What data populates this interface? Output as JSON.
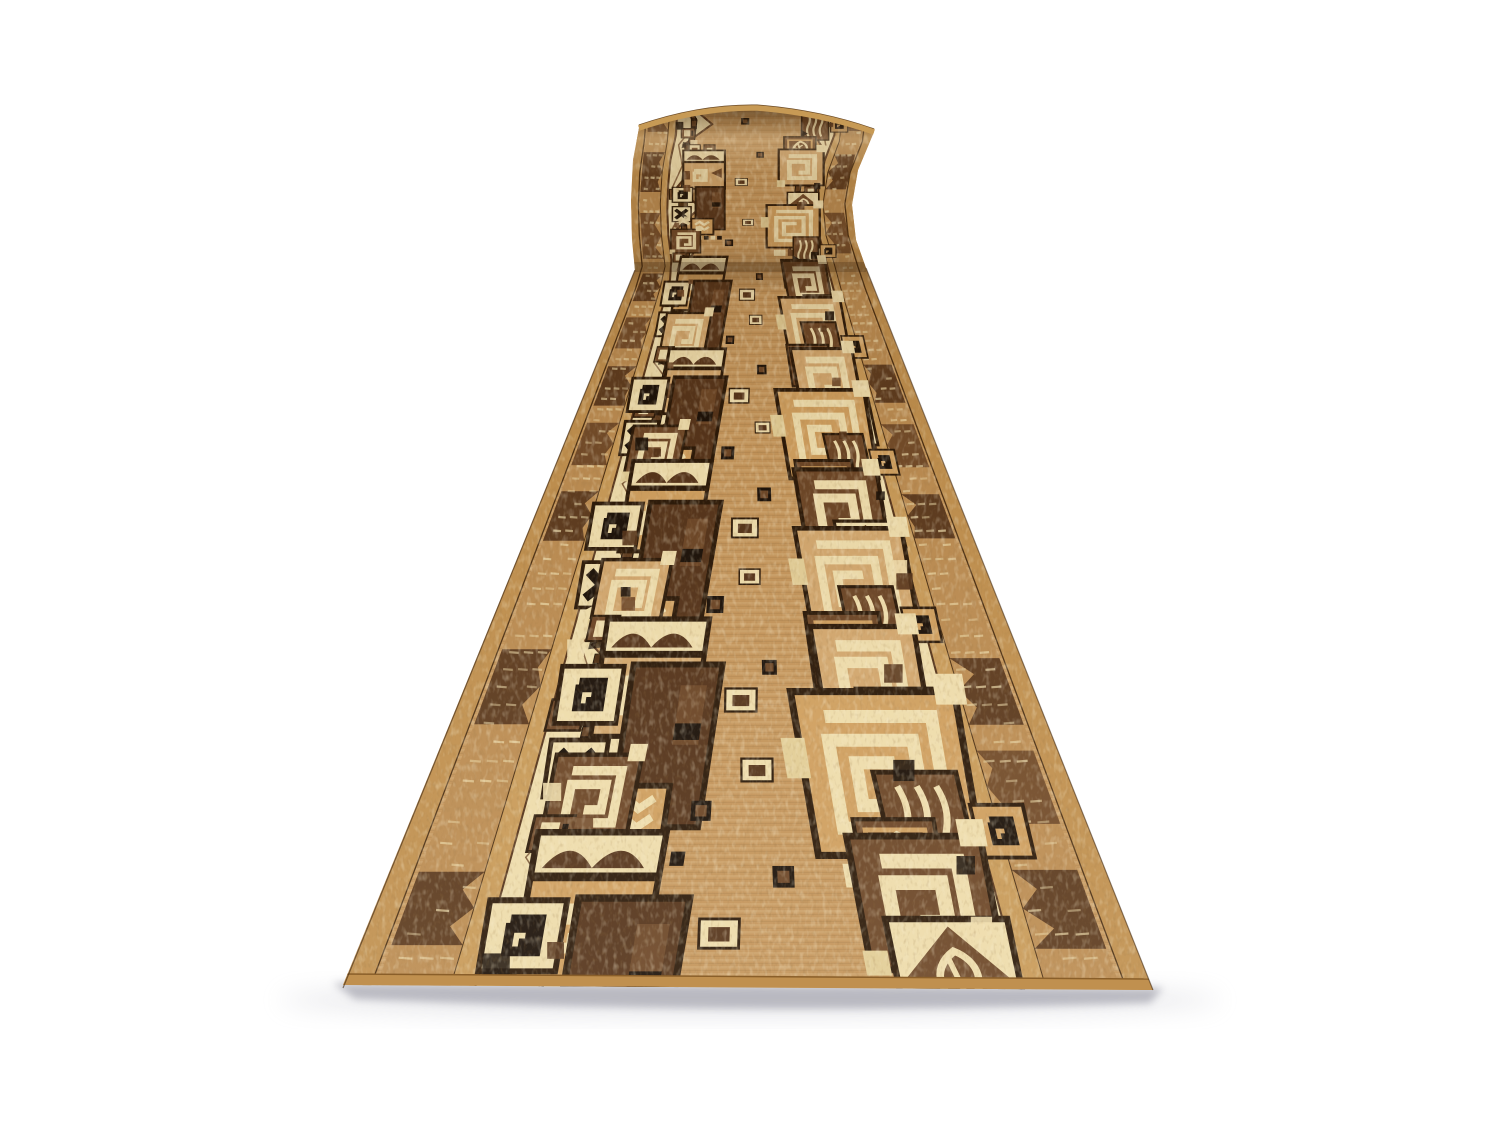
{
  "scene": {
    "kind": "product-photo",
    "subject": "beige-brown ethnic runner carpet, rolled at far end",
    "background_color": "#ffffff"
  },
  "palette": {
    "bg": "#ffffff",
    "field": "#c3945a",
    "fieldLight": "#d2a76e",
    "cream": "#eedcab",
    "creamDeep": "#e2cd96",
    "camel": "#c0904f",
    "camelLight": "#cf9f5f",
    "stripe": "#c89a58",
    "borderTan": "#bb8c52",
    "brown": "#6b4526",
    "brownDeep": "#54331a",
    "stem": "#5a381c",
    "outline": "#2a1808",
    "black": "#1a1008",
    "rim": "#c79a55",
    "shadow": "#a9a9b2",
    "shadowSoft": "#bcbcc4"
  },
  "geometry": {
    "canvas": {
      "w": 1500,
      "h": 1125
    },
    "flat": {
      "yTop": 270,
      "yBot": 988,
      "xLTop": 635,
      "xRTop": 866,
      "xLBot": 343,
      "xRBot": 1153
    },
    "repeats": 4.5,
    "rollStep": 125,
    "rollLeft": [
      [
        128,
        639
      ],
      [
        160,
        633
      ],
      [
        200,
        631
      ],
      [
        240,
        632
      ],
      [
        270,
        635
      ]
    ],
    "rollRight": [
      [
        132,
        874
      ],
      [
        170,
        858
      ],
      [
        205,
        852
      ],
      [
        240,
        856
      ],
      [
        268,
        866
      ]
    ],
    "rugOutline": "M343,985 L635,270 L632,240 L631,200 L633,160 L639,128 Q700,107 757,108 Q820,113 874,132 L858,170 L852,205 L856,240 L866,268 L1153,990 Z",
    "rollOutline": "M635,272 L632,240 L631,200 L633,160 L639,128 Q700,107 757,108 Q820,113 874,132 L858,170 L852,205 L856,240 L866,268 L866,272 Z",
    "topArc": "M639,128 Q700,107 757,108 Q820,113 874,132",
    "bottomSelvedge": [
      [
        343,
        974
      ],
      [
        1153,
        979
      ],
      [
        1153,
        990
      ],
      [
        343,
        985
      ]
    ]
  },
  "pattern": {
    "seed": 11,
    "bands": {
      "selvedge": [
        0,
        0.034
      ],
      "border": [
        0.04,
        0.132
      ],
      "stripe": [
        0.132,
        0.163
      ],
      "creamOuter": 0.163,
      "valleyU": 0.205,
      "peakMin": 0.27,
      "peakMax": 0.335,
      "peaksPerRepeat": 3,
      "stemL": 0.235,
      "stemR": 0.745,
      "stemHalf": 0.012
    },
    "motifs": [
      {
        "s": 0.03,
        "u": 0.295,
        "sz": 0.09,
        "type": "pair"
      },
      {
        "s": 0.2,
        "u": 0.305,
        "sz": 0.16,
        "type": "arch_spiral"
      },
      {
        "s": 0.38,
        "u": 0.21,
        "sz": 0.055,
        "type": "box"
      },
      {
        "s": 0.52,
        "u": 0.3,
        "sz": 0.18,
        "type": "dark_cluster"
      },
      {
        "s": 0.74,
        "u": 0.255,
        "sz": 0.12,
        "type": "spiral"
      },
      {
        "s": 0.9,
        "u": 0.215,
        "sz": 0.05,
        "type": "box"
      },
      {
        "s": 0.02,
        "u": 0.7,
        "sz": 0.11,
        "type": "leaf"
      },
      {
        "s": 0.18,
        "u": 0.73,
        "sz": 0.15,
        "type": "spiral"
      },
      {
        "s": 0.36,
        "u": 0.8,
        "sz": 0.055,
        "type": "box"
      },
      {
        "s": 0.48,
        "u": 0.775,
        "sz": 0.12,
        "type": "leaf_diamond"
      },
      {
        "s": 0.64,
        "u": 0.715,
        "sz": 0.18,
        "type": "spiral_big"
      },
      {
        "s": 0.86,
        "u": 0.785,
        "sz": 0.13,
        "type": "chevron_cluster"
      },
      {
        "s": 0.3,
        "u": 0.475,
        "sz": 0.05,
        "type": "float_rect"
      },
      {
        "s": 0.6,
        "u": 0.52,
        "sz": 0.042,
        "type": "float_rect"
      },
      {
        "s": 0.8,
        "u": 0.445,
        "sz": 0.032,
        "type": "dot"
      },
      {
        "s": 0.1,
        "u": 0.555,
        "sz": 0.03,
        "type": "dot"
      }
    ],
    "accentsPerRepeat": 3
  },
  "shadow": {
    "coreOpacity": 0.75,
    "softOpacity": 0.35
  }
}
